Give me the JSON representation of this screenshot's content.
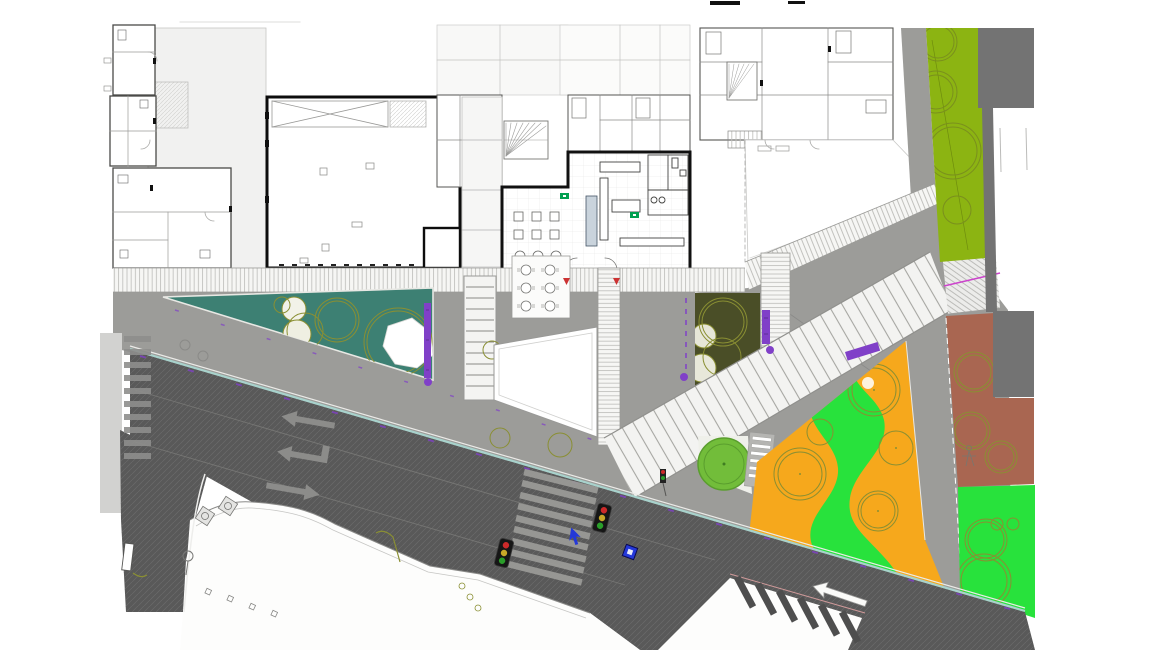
{
  "meta": {
    "title": "Architectural site plan — ground floor, street intersection with pocket parks",
    "width": 1156,
    "height": 650,
    "visible_text": "none"
  },
  "palette": {
    "page_bg": "#ffffff",
    "road_asphalt": "#595959",
    "road_hatch_line": "#6c6c6c",
    "sidewalk_gray": "#a6a6a3",
    "plaza_gray": "#9c9c99",
    "light_gray_block": "#d2d2d0",
    "building_white": "#ffffff",
    "building_light": "#f1f1f0",
    "wall_dark": "#2e2e2e",
    "teal_lawn": "#3d8073",
    "dark_olive_bed": "#4a4e27",
    "olive_verge": "#8cb412",
    "bright_green": "#28e23c",
    "orange_play": "#f6a81c",
    "terracotta": "#a96651",
    "tree_olive": "#8a8f33",
    "tree_fill_green": "#72bd3a",
    "tree_ring_green": "#5a9e2e",
    "bench_purple": "#8040c8",
    "magenta_line": "#cc44cc",
    "curb_cyan": "#a8d2cc",
    "curb_pink": "#d09a9a",
    "dark_block": "#737373",
    "signal_red": "#cc2a2a",
    "signal_amber": "#c8a828",
    "signal_green": "#2a9e2a",
    "exit_sign_green": "#00a050",
    "road_marking_gray": "#8c8c8a",
    "blue_marking": "#2438d8",
    "crosswalk_dark": "#4e4e4e",
    "elevator_blue": "#c9d3dc"
  },
  "areas": [
    {
      "id": "teal-lawn",
      "label": "teal lawn triangle with trees and white canopy"
    },
    {
      "id": "dark-olive-bed",
      "label": "dark olive planting bed"
    },
    {
      "id": "orange-playground",
      "label": "orange play surface with green path and trees"
    },
    {
      "id": "terracotta-court",
      "label": "terracotta planted court"
    },
    {
      "id": "south-green-lawn",
      "label": "bright green lawn"
    },
    {
      "id": "olive-verge",
      "label": "olive green verge with street trees"
    }
  ],
  "road": {
    "lane_arrows": [
      "straight-left",
      "left-turn",
      "straight-right"
    ],
    "traffic_signals": 3,
    "crosswalks": [
      "west-zebra",
      "center-zebra",
      "south-zebra"
    ],
    "vehicles": [
      "blue-car"
    ]
  },
  "site_elements": {
    "purple_benches": 3,
    "purple_markers": 3,
    "stairs": [
      "ladder-stair",
      "grand-steps",
      "side-steps",
      "ramp-steps",
      "fan-stair-1",
      "fan-stair-2"
    ],
    "street_lights": 3,
    "tree_canopies": "outlined olive circles"
  }
}
